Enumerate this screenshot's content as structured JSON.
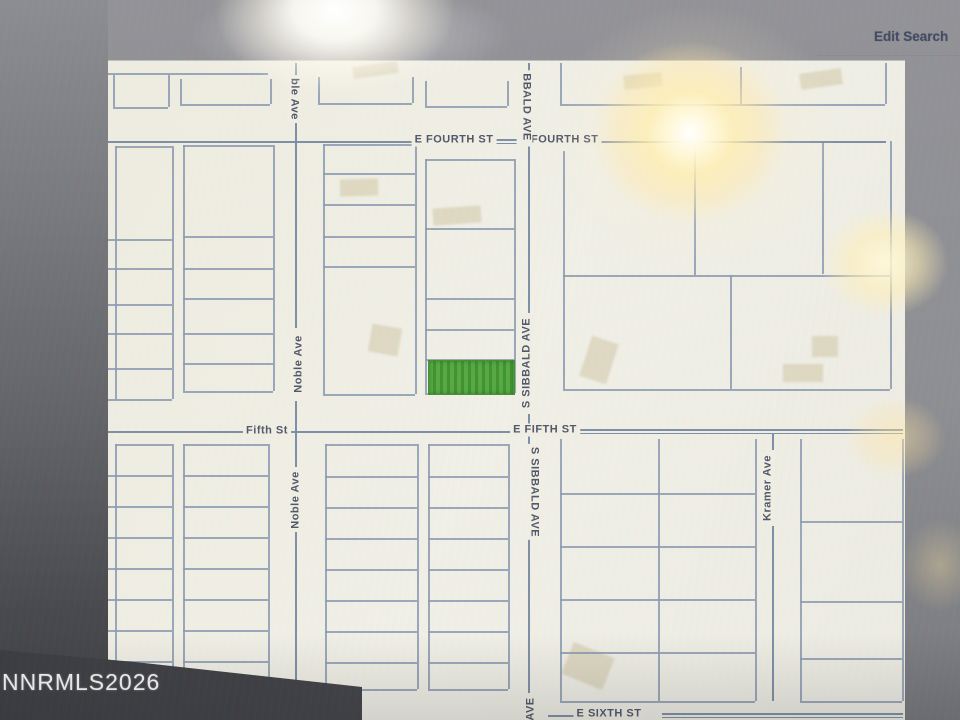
{
  "header": {
    "edit_search_label": "Edit Search"
  },
  "watermark": "NNRMLS2026",
  "colors": {
    "map_bg": "#f2f1e5",
    "parcel_line": "#8a99af",
    "street_line": "#7488a0",
    "label_text": "#4d5365",
    "highlight_green": "#51a93e",
    "highlight_green_dark": "#3e9029",
    "accent_text": "#3d4660"
  },
  "map": {
    "highlight_parcel": {
      "x": 428,
      "y": 359,
      "w": 85,
      "h": 33
    },
    "street_labels": [
      {
        "name": "street-label-e-fourth-st-west",
        "text": "E FOURTH ST",
        "x": 454,
        "y": 139,
        "rot": 0
      },
      {
        "name": "street-label-e-fourth-st-east",
        "text": "E FOURTH ST",
        "x": 559,
        "y": 139,
        "rot": 0
      },
      {
        "name": "street-label-fifth-st",
        "text": "Fifth St",
        "x": 267,
        "y": 430,
        "rot": 0
      },
      {
        "name": "street-label-e-fifth-st",
        "text": "E FIFTH ST",
        "x": 545,
        "y": 429,
        "rot": 0
      },
      {
        "name": "street-label-e-sixth-st",
        "text": "E SIXTH ST",
        "x": 609,
        "y": 713,
        "rot": 0
      },
      {
        "name": "street-label-noble-ave-top",
        "text": "ble Ave",
        "x": 294,
        "y": 98,
        "rot": 90
      },
      {
        "name": "street-label-noble-ave-mid",
        "text": "Noble Ave",
        "x": 299,
        "y": 363,
        "rot": -90
      },
      {
        "name": "street-label-noble-ave-south",
        "text": "Noble Ave",
        "x": 296,
        "y": 499,
        "rot": -90
      },
      {
        "name": "street-label-sibbald-ave-top",
        "text": "BBALD AVE",
        "x": 526,
        "y": 106,
        "rot": 90
      },
      {
        "name": "street-label-s-sibbald-ave-mid",
        "text": "S SIBBALD AVE",
        "x": 527,
        "y": 362,
        "rot": -90
      },
      {
        "name": "street-label-s-sibbald-ave-south",
        "text": "S SIBBALD AVE",
        "x": 534,
        "y": 491,
        "rot": 90
      },
      {
        "name": "street-label-ave-bottom",
        "text": "AVE",
        "x": 531,
        "y": 708,
        "rot": -90
      },
      {
        "name": "street-label-kramer-ave",
        "text": "Kramer Ave",
        "x": 768,
        "y": 487,
        "rot": -90
      }
    ],
    "streets_h": [
      [
        108,
        418,
        140
      ],
      [
        592,
        886,
        140
      ],
      [
        492,
        527,
        138.2
      ],
      [
        492,
        527,
        141.6
      ],
      [
        108,
        243,
        430
      ],
      [
        291,
        516,
        430
      ],
      [
        578,
        903,
        428.4
      ],
      [
        578,
        903,
        431.8
      ],
      [
        548,
        578,
        714
      ],
      [
        662,
        903,
        712.2
      ],
      [
        662,
        903,
        715.6
      ]
    ],
    "streets_v": [
      [
        295,
        62,
        75
      ],
      [
        295,
        121,
        327
      ],
      [
        295,
        400,
        466
      ],
      [
        295,
        531,
        688
      ],
      [
        528,
        62,
        70
      ],
      [
        528,
        143,
        312
      ],
      [
        528,
        413,
        445
      ],
      [
        528,
        536,
        692
      ],
      [
        772,
        433,
        449
      ],
      [
        772,
        525,
        700
      ]
    ],
    "parcels_h": [
      [
        108,
        268,
        72
      ],
      [
        113,
        168,
        106
      ],
      [
        180,
        270,
        103
      ],
      [
        318,
        412,
        102
      ],
      [
        425,
        507,
        105
      ],
      [
        560,
        885,
        103
      ],
      [
        115,
        172,
        145
      ],
      [
        108,
        172,
        238
      ],
      [
        108,
        172,
        267
      ],
      [
        108,
        172,
        303
      ],
      [
        108,
        172,
        332
      ],
      [
        108,
        172,
        367
      ],
      [
        108,
        172,
        398
      ],
      [
        183,
        273,
        144
      ],
      [
        183,
        273,
        235
      ],
      [
        183,
        273,
        267
      ],
      [
        183,
        273,
        297
      ],
      [
        183,
        273,
        332
      ],
      [
        183,
        273,
        362
      ],
      [
        183,
        273,
        390
      ],
      [
        323,
        415,
        143
      ],
      [
        323,
        415,
        172
      ],
      [
        323,
        415,
        203
      ],
      [
        323,
        415,
        235
      ],
      [
        323,
        415,
        265
      ],
      [
        323,
        415,
        393
      ],
      [
        425,
        514,
        158
      ],
      [
        425,
        514,
        227
      ],
      [
        425,
        514,
        297
      ],
      [
        425,
        514,
        328
      ],
      [
        425,
        514,
        358
      ],
      [
        425,
        514,
        392
      ],
      [
        563,
        890,
        274
      ],
      [
        563,
        890,
        388
      ],
      [
        115,
        172,
        443
      ],
      [
        183,
        268,
        443
      ],
      [
        108,
        172,
        474
      ],
      [
        108,
        172,
        505
      ],
      [
        108,
        172,
        536
      ],
      [
        108,
        172,
        567
      ],
      [
        108,
        172,
        598
      ],
      [
        108,
        172,
        629
      ],
      [
        108,
        172,
        660
      ],
      [
        108,
        172,
        688
      ],
      [
        183,
        268,
        474
      ],
      [
        183,
        268,
        505
      ],
      [
        183,
        268,
        536
      ],
      [
        183,
        268,
        567
      ],
      [
        183,
        268,
        598
      ],
      [
        183,
        268,
        629
      ],
      [
        183,
        268,
        660
      ],
      [
        183,
        268,
        688
      ],
      [
        325,
        417,
        443
      ],
      [
        428,
        508,
        443
      ],
      [
        325,
        417,
        475
      ],
      [
        325,
        417,
        506
      ],
      [
        325,
        417,
        537
      ],
      [
        325,
        417,
        568
      ],
      [
        325,
        417,
        599
      ],
      [
        325,
        417,
        630
      ],
      [
        325,
        417,
        661
      ],
      [
        325,
        417,
        688
      ],
      [
        428,
        508,
        475
      ],
      [
        428,
        508,
        506
      ],
      [
        428,
        508,
        537
      ],
      [
        428,
        508,
        568
      ],
      [
        428,
        508,
        599
      ],
      [
        428,
        508,
        630
      ],
      [
        428,
        508,
        661
      ],
      [
        428,
        508,
        688
      ],
      [
        560,
        755,
        492
      ],
      [
        560,
        755,
        545
      ],
      [
        560,
        755,
        598
      ],
      [
        560,
        755,
        651
      ],
      [
        560,
        755,
        700
      ],
      [
        800,
        902,
        520
      ],
      [
        800,
        902,
        600
      ],
      [
        800,
        902,
        657
      ],
      [
        800,
        902,
        700
      ]
    ],
    "parcels_v": [
      [
        113,
        74,
        106
      ],
      [
        168,
        74,
        106
      ],
      [
        180,
        78,
        103
      ],
      [
        270,
        78,
        103
      ],
      [
        318,
        76,
        102
      ],
      [
        412,
        76,
        102
      ],
      [
        425,
        80,
        105
      ],
      [
        507,
        80,
        105
      ],
      [
        560,
        62,
        103
      ],
      [
        740,
        66,
        103
      ],
      [
        885,
        62,
        103
      ],
      [
        115,
        145,
        398
      ],
      [
        172,
        145,
        398
      ],
      [
        183,
        144,
        390
      ],
      [
        273,
        144,
        390
      ],
      [
        323,
        143,
        393
      ],
      [
        415,
        143,
        393
      ],
      [
        425,
        158,
        392
      ],
      [
        514,
        158,
        392
      ],
      [
        563,
        150,
        388
      ],
      [
        694,
        143,
        274
      ],
      [
        822,
        140,
        273
      ],
      [
        890,
        140,
        388
      ],
      [
        730,
        274,
        388
      ],
      [
        115,
        443,
        688
      ],
      [
        172,
        443,
        688
      ],
      [
        183,
        443,
        688
      ],
      [
        268,
        443,
        688
      ],
      [
        325,
        443,
        688
      ],
      [
        417,
        443,
        688
      ],
      [
        428,
        443,
        688
      ],
      [
        508,
        443,
        688
      ],
      [
        560,
        438,
        700
      ],
      [
        658,
        438,
        700
      ],
      [
        755,
        438,
        700
      ],
      [
        800,
        438,
        700
      ],
      [
        902,
        438,
        700
      ]
    ],
    "buildings": [
      [
        353,
        63,
        45,
        12,
        -8
      ],
      [
        624,
        73,
        38,
        14,
        -5
      ],
      [
        800,
        70,
        42,
        16,
        -8
      ],
      [
        340,
        178,
        38,
        17,
        -2
      ],
      [
        370,
        325,
        30,
        28,
        10
      ],
      [
        433,
        206,
        48,
        17,
        -4
      ],
      [
        585,
        338,
        28,
        42,
        18
      ],
      [
        812,
        335,
        26,
        21,
        0
      ],
      [
        783,
        363,
        40,
        18,
        0
      ],
      [
        566,
        648,
        44,
        34,
        22
      ]
    ]
  }
}
